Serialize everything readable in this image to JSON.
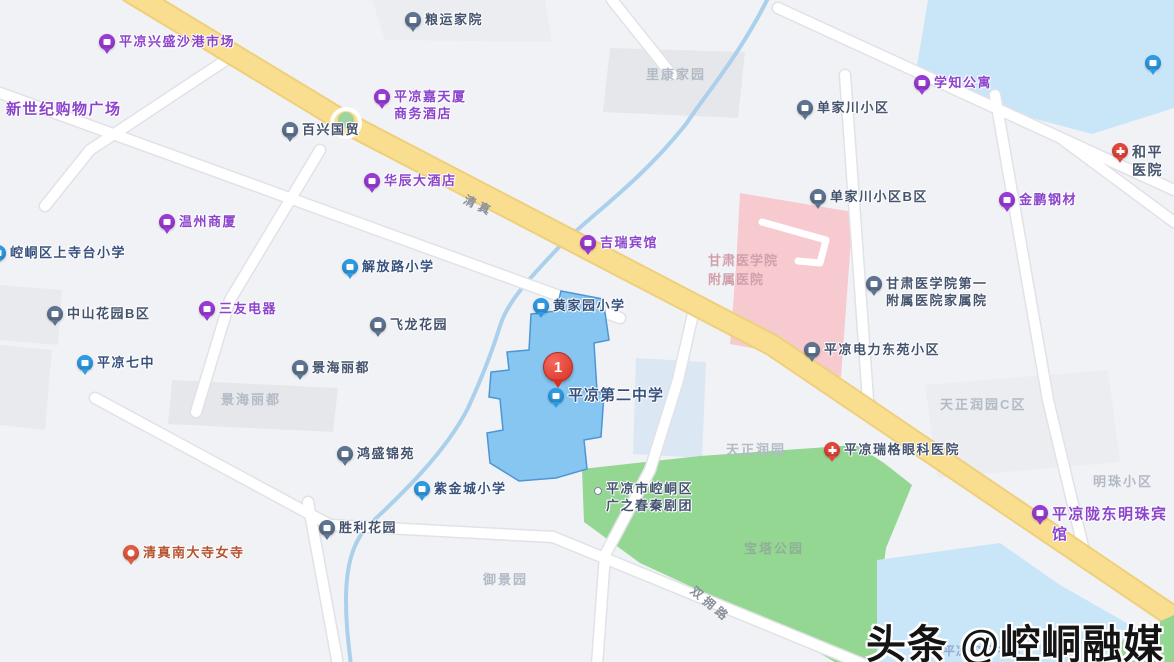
{
  "map_title": "平凉第二中学周边地图",
  "selected_place": {
    "marker_number": "1",
    "name": "平凉第二中学"
  },
  "watermark": {
    "text": "头条 @崆峒融媒"
  },
  "colors": {
    "background": "#F1F2F5",
    "campus_fill": "#7EC2EF",
    "campus_border": "#4E95D5",
    "water": "#C9E5F8",
    "park_green": "#93D793",
    "hospital_pink": "#F7CACF",
    "major_road": "#FADE90",
    "purple_poi": "#8B44CC",
    "marker_red": "#D93025"
  },
  "pois": [
    {
      "label": "平凉兴盛沙港市场",
      "pin": "purple"
    },
    {
      "label": "粮运家院",
      "pin": "slate"
    },
    {
      "label": "新世纪购物广场",
      "pin": "none"
    },
    {
      "label": "平凉嘉天厦\n商务酒店",
      "pin": "purple"
    },
    {
      "label": "百兴国贸",
      "pin": "slate"
    },
    {
      "label": "华辰大酒店",
      "pin": "purple"
    },
    {
      "label": "温州商厦",
      "pin": "purple"
    },
    {
      "label": "崆峒区上寺台小学",
      "pin": "blue"
    },
    {
      "label": "解放路小学",
      "pin": "blue"
    },
    {
      "label": "三友电器",
      "pin": "purple"
    },
    {
      "label": "中山花园B区",
      "pin": "slate"
    },
    {
      "label": "飞龙花园",
      "pin": "slate"
    },
    {
      "label": "平凉七中",
      "pin": "blue"
    },
    {
      "label": "景海丽都",
      "pin": "slate"
    },
    {
      "label": "黄家园小学",
      "pin": "blue"
    },
    {
      "label": "吉瑞宾馆",
      "pin": "purple"
    },
    {
      "label": "学知公寓",
      "pin": "purple"
    },
    {
      "label": "单家川小区",
      "pin": "slate"
    },
    {
      "label": "单家川小区B区",
      "pin": "slate"
    },
    {
      "label": "金鹏钢材",
      "pin": "purple"
    },
    {
      "label": "和平医院",
      "pin": "red"
    },
    {
      "label": "甘肃医学院第一\n附属医院家属院",
      "pin": "slate"
    },
    {
      "label": "平凉电力东苑小区",
      "pin": "slate"
    },
    {
      "label": "鸿盛锦苑",
      "pin": "slate"
    },
    {
      "label": "紫金城小学",
      "pin": "blue"
    },
    {
      "label": "胜利花园",
      "pin": "slate"
    },
    {
      "label": "清真南大寺女寺",
      "pin": "orange"
    },
    {
      "label": "平凉瑞格眼科医院",
      "pin": "red"
    },
    {
      "label": "平凉陇东明珠宾馆",
      "pin": "purple"
    },
    {
      "label": "平凉第二中学",
      "pin": "blue"
    },
    {
      "label": "平凉市崆峒区\n广之春秦剧团",
      "pin": "dot"
    },
    {
      "label": "",
      "pin": "blue"
    }
  ],
  "area_labels": [
    {
      "label": "里康家园"
    },
    {
      "label": "景海丽都"
    },
    {
      "label": "天正润园C区"
    },
    {
      "label": "天正润园"
    },
    {
      "label": "明珠小区"
    },
    {
      "label": "宝塔公园"
    },
    {
      "label": "御景园"
    },
    {
      "label": "甘肃医学院\n附属医院"
    },
    {
      "label": "平凉实验中学"
    }
  ],
  "road_labels": [
    {
      "label": "清真"
    },
    {
      "label": "双拥路"
    }
  ]
}
